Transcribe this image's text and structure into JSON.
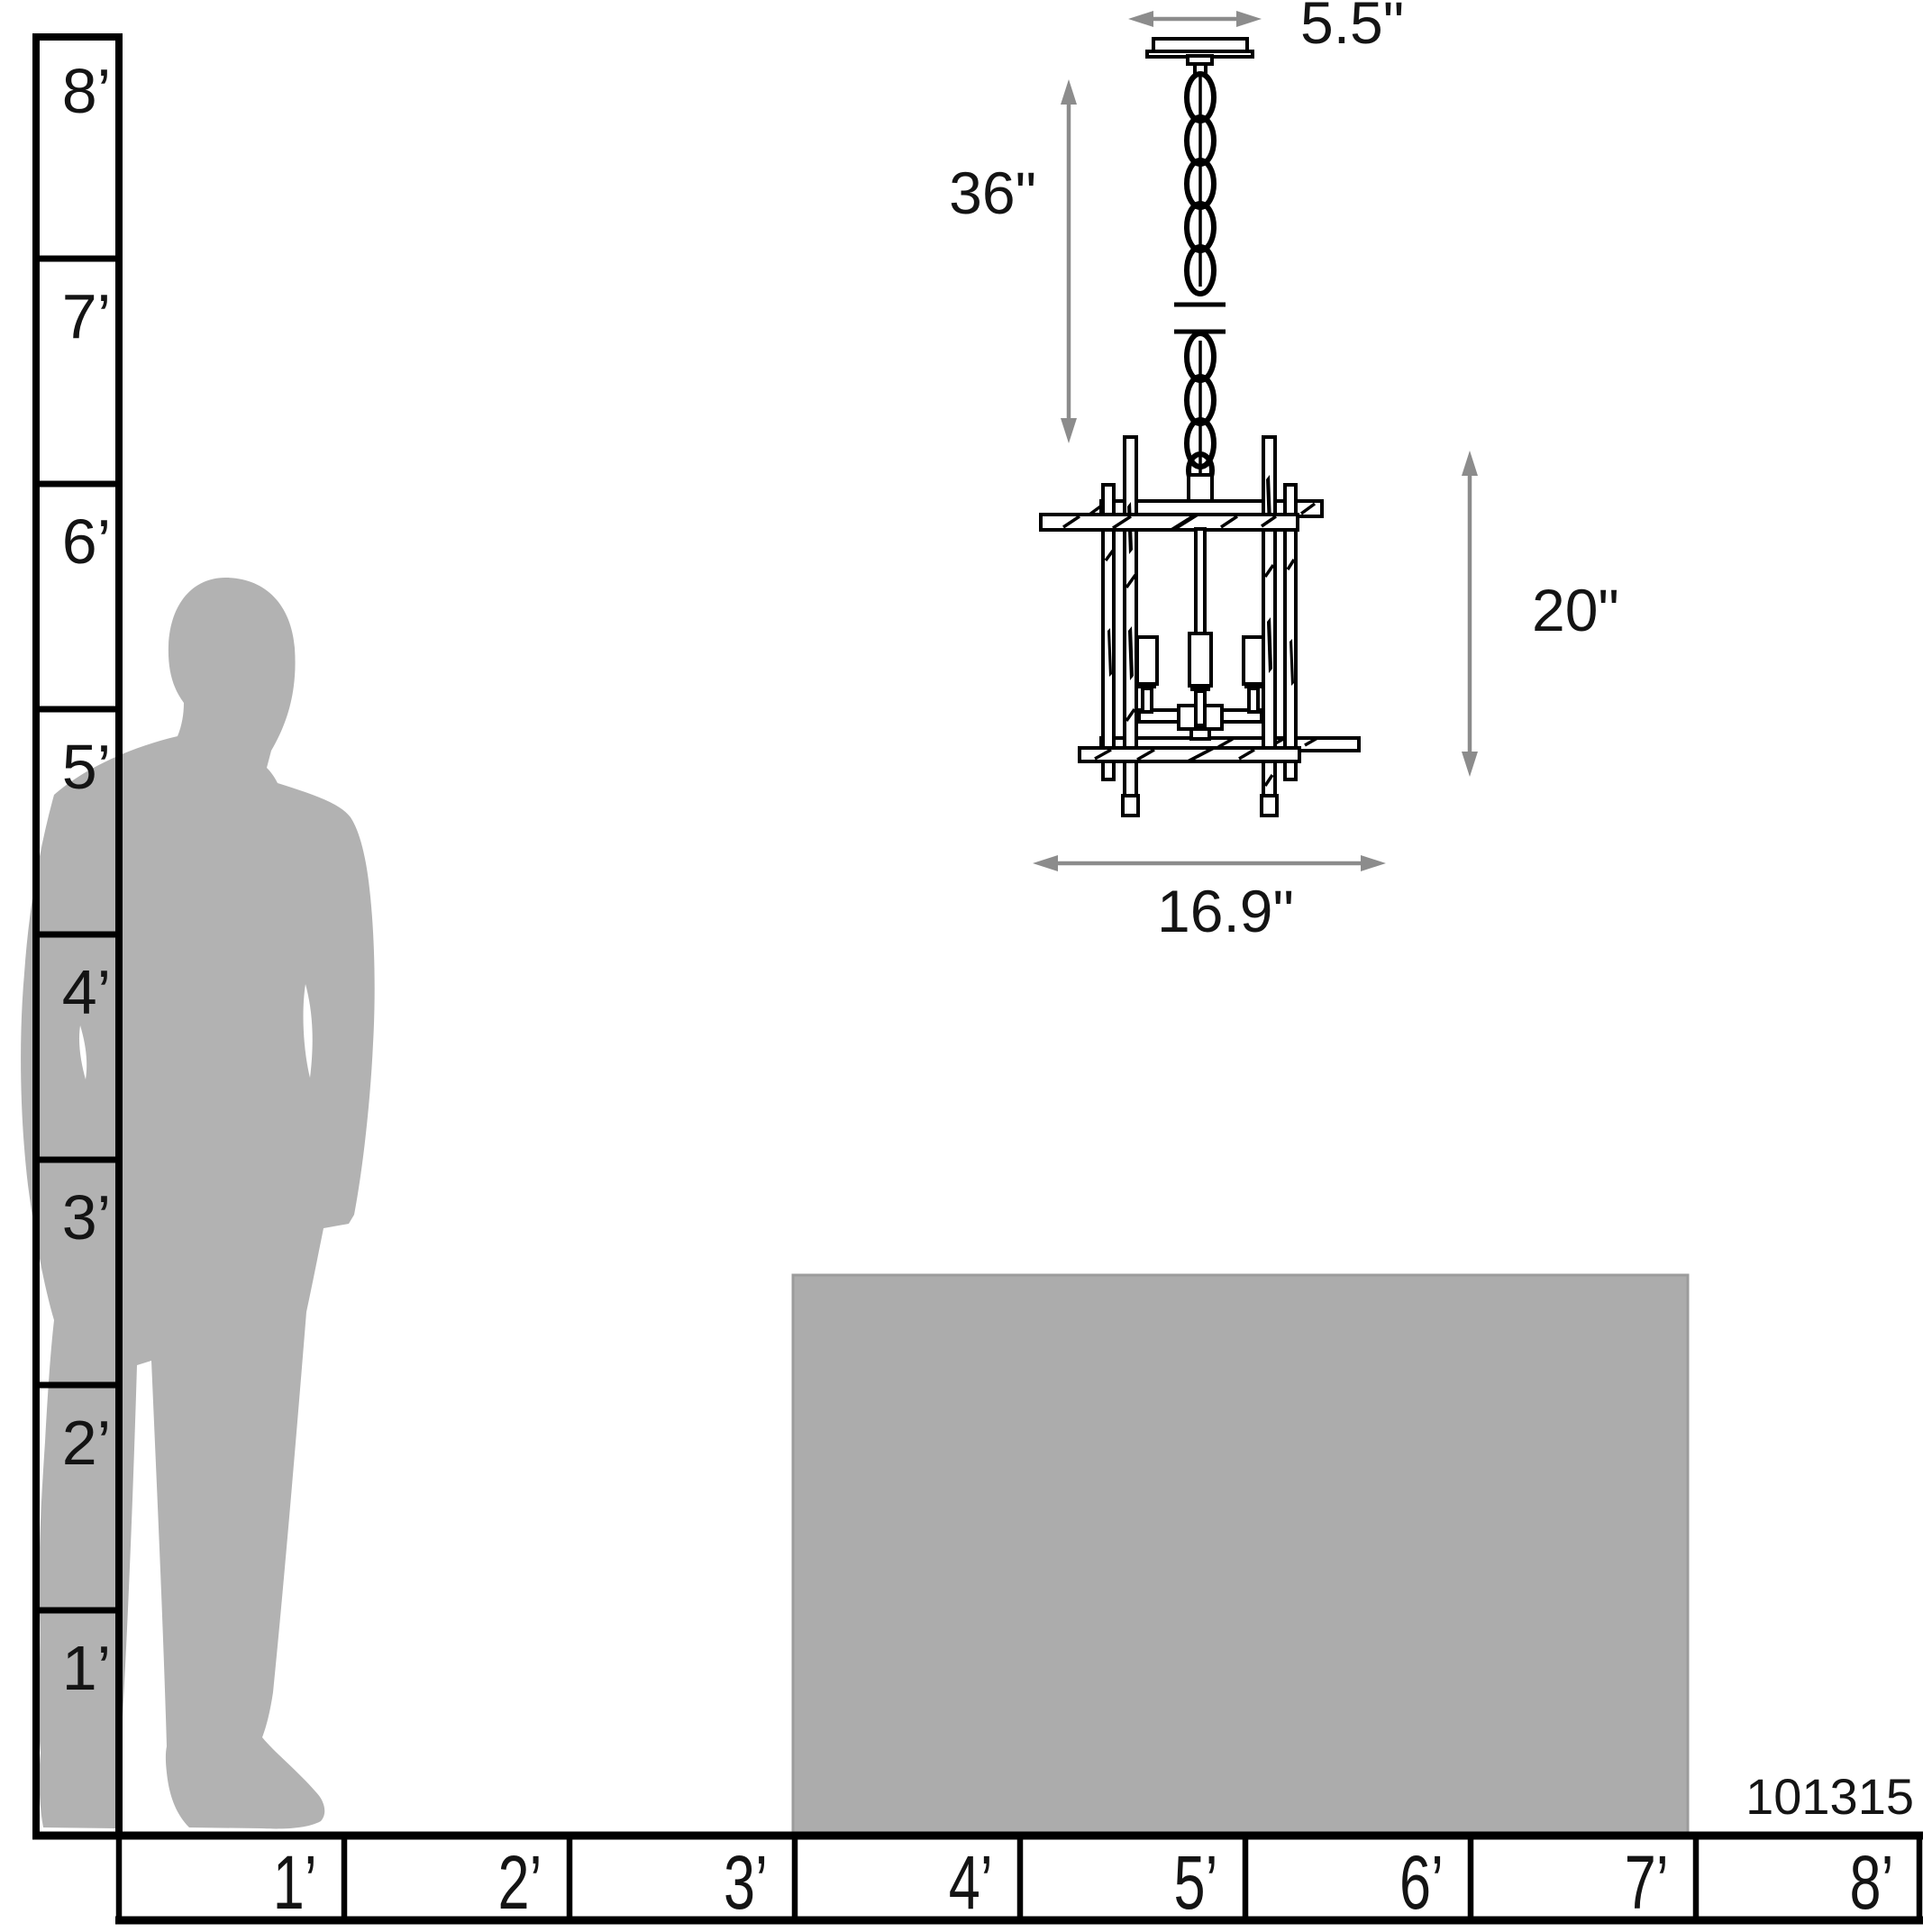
{
  "product_number": "101315",
  "colors": {
    "line": "#000000",
    "label_text": "#141414",
    "dimension_arrow": "#8c8c8c",
    "silhouette": "#b2b2b2",
    "table_fill": "#acacac",
    "table_border": "#9c9c9c",
    "background": "#ffffff"
  },
  "height_ruler": {
    "labels": [
      "8’",
      "7’",
      "6’",
      "5’",
      "4’",
      "3’",
      "2’",
      "1’"
    ]
  },
  "width_ruler": {
    "labels": [
      "1’",
      "2’",
      "3’",
      "4’",
      "5’",
      "6’",
      "7’",
      "8’"
    ]
  },
  "dimensions": {
    "canopy_width": "5.5\"",
    "chain_length": "36\"",
    "fixture_height": "20\"",
    "fixture_width": "16.9\""
  }
}
